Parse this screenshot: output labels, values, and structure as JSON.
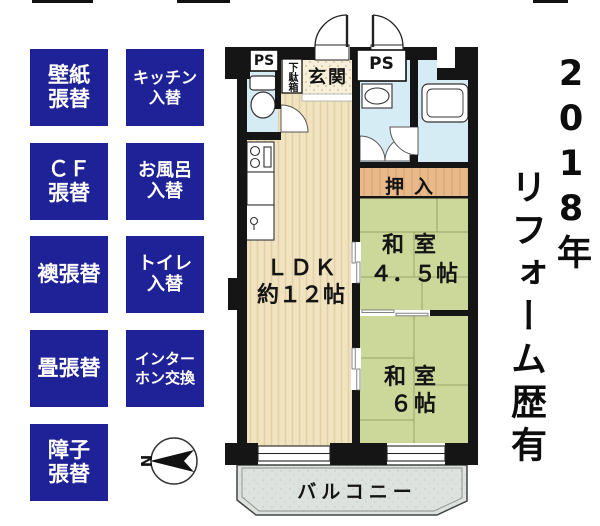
{
  "renovation_badges": [
    {
      "id": "wallpaper",
      "lines": [
        "壁紙",
        "張替"
      ]
    },
    {
      "id": "kitchen",
      "lines": [
        "キッチン",
        "入替"
      ]
    },
    {
      "id": "cf",
      "lines": [
        "ＣＦ",
        "張替"
      ]
    },
    {
      "id": "bath",
      "lines": [
        "お風呂",
        "入替"
      ]
    },
    {
      "id": "fusuma",
      "lines": [
        "襖張替"
      ]
    },
    {
      "id": "toilet",
      "lines": [
        "トイレ",
        "入替"
      ]
    },
    {
      "id": "tatami",
      "lines": [
        "畳張替"
      ]
    },
    {
      "id": "intercom",
      "lines": [
        "インター",
        "ホン交換"
      ]
    },
    {
      "id": "shoji",
      "lines": [
        "障子",
        "張替"
      ]
    }
  ],
  "floorplan": {
    "ps1": "PS",
    "ps2": "PS",
    "getabako": "下駄箱",
    "genkan": "玄関",
    "oshiire": "押入",
    "ldk": {
      "name": "ＬＤＫ",
      "size": "約１２帖"
    },
    "washitsu_45": {
      "name": "和室",
      "size": "４．５帖"
    },
    "washitsu_6": {
      "name": "和室",
      "size": "６帖"
    },
    "balcony": "バルコニー",
    "compass_north": "N"
  },
  "side_note": {
    "year": "2018年",
    "text": "リフォーム歴有"
  },
  "colors": {
    "badge_blue": "#1e2296",
    "wall": "#151515",
    "wood_floor": "#f1e3bf",
    "tatami_green": "#ccd79a",
    "tatami_line": "#97a668",
    "water_blue": "#d6ecf5",
    "closet_orange": "#e8ba8b",
    "genkan_floor": "#f7efd9",
    "balcony_gray": "#dee2de",
    "text_white": "#ffffff",
    "text_black": "#0d0d0d"
  }
}
